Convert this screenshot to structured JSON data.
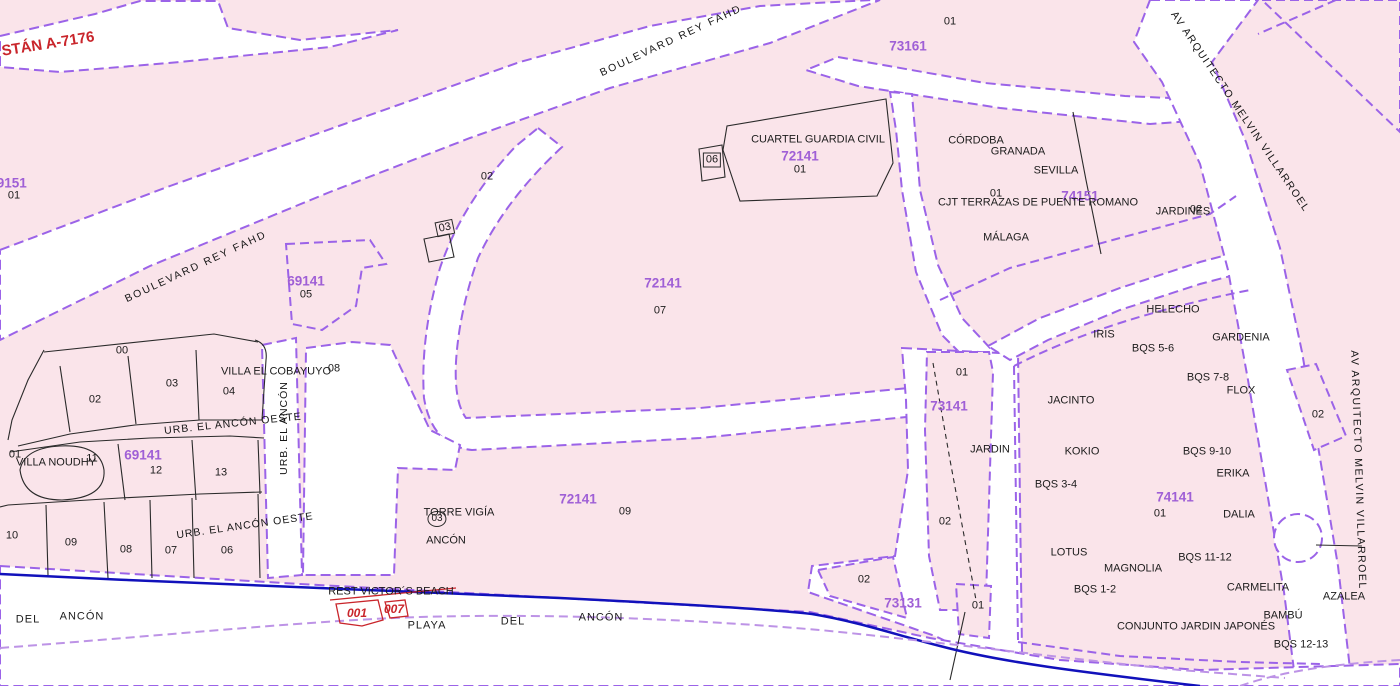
{
  "map": {
    "type": "cadastral-parcel-map",
    "colors": {
      "parcel_fill": "#FAE4EA",
      "road_fill": "#FFFFFF",
      "boundary_purple": "#9B63E8",
      "beach_line_purple": "#BD93E6",
      "coastline_blue": "#1111BB",
      "parcel_ref_purple": "#9F5FD6",
      "red_reference": "#C9252B",
      "black_line": "#222222"
    },
    "street_names": [
      "BOULEVARD REY FAHD",
      "AV ARQUITECTO MELVIN VILLARROEL",
      "URB. EL ANCÓN",
      "URB. EL ANCÓN OESTE"
    ],
    "parcel_refs": [
      "69151",
      "73161",
      "72141",
      "74151",
      "69141",
      "73141",
      "74141",
      "73131"
    ],
    "labels": [
      {
        "name": "street-boulevard-rey-fahd-west",
        "t": "BOULEVARD REY FAHD",
        "x": 196,
        "y": 267,
        "rot": -25,
        "cls": "street",
        "fs": 10.5,
        "ls": 2
      },
      {
        "name": "street-boulevard-rey-fahd-east",
        "t": "BOULEVARD REY FAHD",
        "x": 671,
        "y": 41,
        "rot": -25,
        "cls": "street",
        "fs": 10.5,
        "ls": 2
      },
      {
        "name": "street-av-arquitecto-melvin-villarroel-north",
        "t": "AV  ARQUITECTO  MELVIN VILLARROEL",
        "x": 1240,
        "y": 112,
        "rot": 56,
        "cls": "street",
        "fs": 10.5,
        "ls": 1.5
      },
      {
        "name": "street-av-arquitecto-melvin-villarroel-south",
        "t": "AV ARQUITECTO MELVIN VILLARROEL",
        "x": 1358,
        "y": 470,
        "rot": 88,
        "cls": "street",
        "fs": 10.5,
        "ls": 1.5
      },
      {
        "name": "street-urb-el-ancon",
        "t": "URB.  EL  ANCÓN",
        "x": 284,
        "y": 428,
        "rot": -90,
        "cls": "street",
        "fs": 10.5,
        "ls": 1
      },
      {
        "name": "street-urb-el-ancon-oeste-1",
        "t": "URB.  EL  ANCÓN  OESTE",
        "x": 233,
        "y": 424,
        "rot": -6,
        "cls": "street",
        "fs": 10.5,
        "ls": 1
      },
      {
        "name": "street-urb-el-ancon-oeste-2",
        "t": "URB.  EL  ANCÓN  OESTE",
        "x": 245,
        "y": 526,
        "rot": -8,
        "cls": "street",
        "fs": 10.5,
        "ls": 1
      },
      {
        "name": "road-ref-a-7176",
        "t": "STÁN A-7176",
        "x": 48,
        "y": 44,
        "rot": -9,
        "cls": "red",
        "fs": 15
      },
      {
        "name": "beach-plot-ref-001",
        "t": "001",
        "x": 357,
        "y": 613,
        "cls": "red-it",
        "fs": 12
      },
      {
        "name": "beach-plot-ref-007",
        "t": "007",
        "x": 394,
        "y": 609,
        "cls": "red-it",
        "fs": 12
      },
      {
        "name": "parcel-ref-69151",
        "t": "69151",
        "x": 8,
        "y": 183,
        "cls": "pur",
        "fs": 13.5
      },
      {
        "name": "parcel-ref-73161",
        "t": "73161",
        "x": 908,
        "y": 46,
        "cls": "pur",
        "fs": 13.5
      },
      {
        "name": "parcel-ref-72141-cuartel",
        "t": "72141",
        "x": 800,
        "y": 156,
        "cls": "pur",
        "fs": 13.5
      },
      {
        "name": "parcel-ref-74151",
        "t": "74151",
        "x": 1080,
        "y": 196,
        "cls": "pur",
        "fs": 13.5
      },
      {
        "name": "parcel-ref-69141-05",
        "t": "69141",
        "x": 306,
        "y": 281,
        "cls": "pur",
        "fs": 13.5
      },
      {
        "name": "parcel-ref-72141-07",
        "t": "72141",
        "x": 663,
        "y": 283,
        "cls": "pur",
        "fs": 13.5
      },
      {
        "name": "parcel-ref-69141-sur",
        "t": "69141",
        "x": 143,
        "y": 455,
        "cls": "pur",
        "fs": 13.5
      },
      {
        "name": "parcel-ref-72141-09",
        "t": "72141",
        "x": 578,
        "y": 499,
        "cls": "pur",
        "fs": 13.5
      },
      {
        "name": "parcel-ref-73141",
        "t": "73141",
        "x": 949,
        "y": 406,
        "cls": "pur",
        "fs": 13.5
      },
      {
        "name": "parcel-ref-74141",
        "t": "74141",
        "x": 1175,
        "y": 497,
        "cls": "pur",
        "fs": 13.5
      },
      {
        "name": "parcel-ref-73131",
        "t": "73131",
        "x": 903,
        "y": 603,
        "cls": "pur",
        "fs": 13.5
      },
      {
        "name": "parcel-num-01-73161",
        "t": "01",
        "x": 950,
        "y": 22,
        "cls": "blk",
        "fs": 11
      },
      {
        "name": "parcel-num-01-cuartel",
        "t": "01",
        "x": 800,
        "y": 170,
        "cls": "blk",
        "fs": 11
      },
      {
        "name": "parcel-num-06-box",
        "t": "06",
        "x": 712,
        "y": 160,
        "cls": "blk boxed",
        "fs": 11
      },
      {
        "name": "parcel-num-02-wedge",
        "t": "02",
        "x": 487,
        "y": 177,
        "cls": "blk",
        "fs": 11
      },
      {
        "name": "parcel-num-03-box",
        "t": "03",
        "x": 445,
        "y": 228,
        "cls": "blk boxed",
        "fs": 11,
        "rot": -12
      },
      {
        "name": "parcel-num-01-terrazas",
        "t": "01",
        "x": 996,
        "y": 194,
        "cls": "blk",
        "fs": 11
      },
      {
        "name": "parcel-num-02-jardines",
        "t": "02",
        "x": 1196,
        "y": 210,
        "cls": "blk",
        "fs": 11
      },
      {
        "name": "parcel-num-07",
        "t": "07",
        "x": 660,
        "y": 311,
        "cls": "blk",
        "fs": 11
      },
      {
        "name": "parcel-num-05",
        "t": "05",
        "x": 306,
        "y": 295,
        "cls": "blk",
        "fs": 11
      },
      {
        "name": "parcel-num-01-69151",
        "t": "01",
        "x": 14,
        "y": 196,
        "cls": "blk",
        "fs": 11
      },
      {
        "name": "parcel-num-00",
        "t": "00",
        "x": 122,
        "y": 351,
        "cls": "blk",
        "fs": 11
      },
      {
        "name": "parcel-num-03",
        "t": "03",
        "x": 172,
        "y": 384,
        "cls": "blk",
        "fs": 11
      },
      {
        "name": "parcel-num-02",
        "t": "02",
        "x": 95,
        "y": 400,
        "cls": "blk",
        "fs": 11
      },
      {
        "name": "parcel-num-04",
        "t": "04",
        "x": 229,
        "y": 392,
        "cls": "blk",
        "fs": 11
      },
      {
        "name": "parcel-num-08-villa",
        "t": "08",
        "x": 334,
        "y": 369,
        "cls": "blk",
        "fs": 11
      },
      {
        "name": "parcel-num-01-noudhy",
        "t": "01",
        "x": 15,
        "y": 455,
        "cls": "blk",
        "fs": 11
      },
      {
        "name": "parcel-num-11",
        "t": "11",
        "x": 92,
        "y": 459,
        "cls": "blk",
        "fs": 11
      },
      {
        "name": "parcel-num-12",
        "t": "12",
        "x": 156,
        "y": 471,
        "cls": "blk",
        "fs": 11
      },
      {
        "name": "parcel-num-13",
        "t": "13",
        "x": 221,
        "y": 473,
        "cls": "blk",
        "fs": 11
      },
      {
        "name": "parcel-num-10",
        "t": "10",
        "x": 12,
        "y": 536,
        "cls": "blk",
        "fs": 11
      },
      {
        "name": "parcel-num-09",
        "t": "09",
        "x": 71,
        "y": 543,
        "cls": "blk",
        "fs": 11
      },
      {
        "name": "parcel-num-08",
        "t": "08",
        "x": 126,
        "y": 550,
        "cls": "blk",
        "fs": 11
      },
      {
        "name": "parcel-num-07-row",
        "t": "07",
        "x": 171,
        "y": 551,
        "cls": "blk",
        "fs": 11
      },
      {
        "name": "parcel-num-06-row",
        "t": "06",
        "x": 227,
        "y": 551,
        "cls": "blk",
        "fs": 11
      },
      {
        "name": "parcel-num-03-torre",
        "t": "03",
        "x": 437,
        "y": 519,
        "cls": "blk circled",
        "fs": 10
      },
      {
        "name": "parcel-num-09-72141",
        "t": "09",
        "x": 625,
        "y": 512,
        "cls": "blk",
        "fs": 11
      },
      {
        "name": "parcel-num-01-73141",
        "t": "01",
        "x": 962,
        "y": 373,
        "cls": "blk",
        "fs": 11
      },
      {
        "name": "parcel-num-02-73141",
        "t": "02",
        "x": 945,
        "y": 522,
        "cls": "blk",
        "fs": 11
      },
      {
        "name": "parcel-num-01-73131",
        "t": "01",
        "x": 978,
        "y": 606,
        "cls": "blk",
        "fs": 11
      },
      {
        "name": "parcel-num-02-73131",
        "t": "02",
        "x": 864,
        "y": 580,
        "cls": "blk",
        "fs": 11
      },
      {
        "name": "parcel-num-02-avenue",
        "t": "02",
        "x": 1318,
        "y": 415,
        "cls": "blk",
        "fs": 11
      },
      {
        "name": "place-cuartel-guardia-civil",
        "t": "CUARTEL GUARDIA CIVIL",
        "x": 818,
        "y": 140,
        "cls": "blk",
        "fs": 11
      },
      {
        "name": "place-cordoba",
        "t": "CÓRDOBA",
        "x": 976,
        "y": 141,
        "cls": "blk",
        "fs": 11
      },
      {
        "name": "place-granada",
        "t": "GRANADA",
        "x": 1018,
        "y": 152,
        "cls": "blk",
        "fs": 11
      },
      {
        "name": "place-sevilla",
        "t": "SEVILLA",
        "x": 1056,
        "y": 171,
        "cls": "blk",
        "fs": 11
      },
      {
        "name": "place-cjt-terrazas-de-puente-romano",
        "t": "CJT TERRAZAS DE PUENTE ROMANO",
        "x": 1038,
        "y": 203,
        "cls": "blk",
        "fs": 11
      },
      {
        "name": "place-malaga",
        "t": "MÁLAGA",
        "x": 1006,
        "y": 238,
        "cls": "blk",
        "fs": 11
      },
      {
        "name": "place-jardines",
        "t": "JARDINES",
        "x": 1183,
        "y": 212,
        "cls": "blk",
        "fs": 11
      },
      {
        "name": "place-villa-el-cobayuyo",
        "t": "VILLA EL COBAYUYO",
        "x": 276,
        "y": 372,
        "cls": "blk",
        "fs": 11
      },
      {
        "name": "place-villa-noudhy",
        "t": "VILLA NOUDHY",
        "x": 56,
        "y": 463,
        "cls": "blk",
        "fs": 11
      },
      {
        "name": "place-torre-vigia",
        "t": "TORRE VIGÍA",
        "x": 459,
        "y": 513,
        "cls": "blk",
        "fs": 11
      },
      {
        "name": "place-ancon-torre",
        "t": "ANCÓN",
        "x": 446,
        "y": 541,
        "cls": "blk",
        "fs": 11
      },
      {
        "name": "place-rest-victors-beach",
        "t": "REST VICTOR´S BEACH",
        "x": 391,
        "y": 592,
        "cls": "blk",
        "fs": 11
      },
      {
        "name": "place-playa",
        "t": "PLAYA",
        "x": 427,
        "y": 626,
        "cls": "blk",
        "fs": 11,
        "ls": 1
      },
      {
        "name": "place-playa-del",
        "t": "DEL",
        "x": 513,
        "y": 622,
        "cls": "blk",
        "fs": 11,
        "ls": 1
      },
      {
        "name": "place-playa-ancon",
        "t": "ANCÓN",
        "x": 601,
        "y": 618,
        "cls": "blk",
        "fs": 11,
        "ls": 1
      },
      {
        "name": "place-del-ancon-del",
        "t": "DEL",
        "x": 28,
        "y": 620,
        "cls": "blk",
        "fs": 11,
        "ls": 1
      },
      {
        "name": "place-del-ancon-ancon",
        "t": "ANCÓN",
        "x": 82,
        "y": 617,
        "cls": "blk",
        "fs": 11,
        "ls": 1
      },
      {
        "name": "place-jardin",
        "t": "JARDIN",
        "x": 990,
        "y": 450,
        "cls": "blk",
        "fs": 11
      },
      {
        "name": "place-helecho",
        "t": "HELECHO",
        "x": 1173,
        "y": 310,
        "cls": "blk",
        "fs": 11
      },
      {
        "name": "place-iris",
        "t": "IRIS",
        "x": 1104,
        "y": 335,
        "cls": "blk",
        "fs": 11
      },
      {
        "name": "place-bqs-5-6",
        "t": "BQS 5-6",
        "x": 1153,
        "y": 349,
        "cls": "blk",
        "fs": 11
      },
      {
        "name": "place-gardenia",
        "t": "GARDENIA",
        "x": 1241,
        "y": 338,
        "cls": "blk",
        "fs": 11
      },
      {
        "name": "place-bqs-7-8",
        "t": "BQS 7-8",
        "x": 1208,
        "y": 378,
        "cls": "blk",
        "fs": 11
      },
      {
        "name": "place-flox",
        "t": "FLOX",
        "x": 1241,
        "y": 391,
        "cls": "blk",
        "fs": 11
      },
      {
        "name": "place-jacinto",
        "t": "JACINTO",
        "x": 1071,
        "y": 401,
        "cls": "blk",
        "fs": 11
      },
      {
        "name": "place-kokio",
        "t": "KOKIO",
        "x": 1082,
        "y": 452,
        "cls": "blk",
        "fs": 11
      },
      {
        "name": "place-bqs-9-10",
        "t": "BQS 9-10",
        "x": 1207,
        "y": 452,
        "cls": "blk",
        "fs": 11
      },
      {
        "name": "place-erika",
        "t": "ERIKA",
        "x": 1233,
        "y": 474,
        "cls": "blk",
        "fs": 11
      },
      {
        "name": "place-bqs-3-4",
        "t": "BQS 3-4",
        "x": 1056,
        "y": 485,
        "cls": "blk",
        "fs": 11
      },
      {
        "name": "parcel-num-01-74141",
        "t": "01",
        "x": 1160,
        "y": 514,
        "cls": "blk",
        "fs": 11
      },
      {
        "name": "place-dalia",
        "t": "DALIA",
        "x": 1239,
        "y": 515,
        "cls": "blk",
        "fs": 11
      },
      {
        "name": "place-lotus",
        "t": "LOTUS",
        "x": 1069,
        "y": 553,
        "cls": "blk",
        "fs": 11
      },
      {
        "name": "place-magnolia",
        "t": "MAGNOLIA",
        "x": 1133,
        "y": 569,
        "cls": "blk",
        "fs": 11
      },
      {
        "name": "place-bqs-11-12",
        "t": "BQS 11-12",
        "x": 1205,
        "y": 558,
        "cls": "blk",
        "fs": 11
      },
      {
        "name": "place-bqs-1-2",
        "t": "BQS 1-2",
        "x": 1095,
        "y": 590,
        "cls": "blk",
        "fs": 11
      },
      {
        "name": "place-carmelita",
        "t": "CARMELITA",
        "x": 1258,
        "y": 588,
        "cls": "blk",
        "fs": 11
      },
      {
        "name": "place-azalea",
        "t": "AZALEA",
        "x": 1344,
        "y": 597,
        "cls": "blk",
        "fs": 11
      },
      {
        "name": "place-bambu",
        "t": "BAMBÚ",
        "x": 1283,
        "y": 616,
        "cls": "blk",
        "fs": 11
      },
      {
        "name": "place-conjunto-jardin-japones",
        "t": "CONJUNTO JARDIN JAPONÉS",
        "x": 1196,
        "y": 627,
        "cls": "blk",
        "fs": 11
      },
      {
        "name": "place-bqs-12-13",
        "t": "BQS 12-13",
        "x": 1301,
        "y": 645,
        "cls": "blk",
        "fs": 11
      }
    ]
  }
}
